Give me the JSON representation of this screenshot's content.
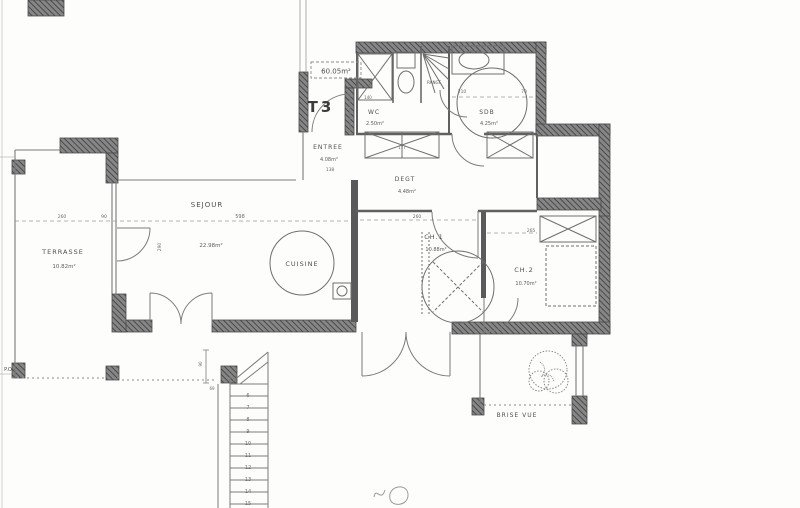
{
  "plan": {
    "unit_label": "T3",
    "total_area": "60.05m²"
  },
  "rooms": {
    "terrasse": {
      "name": "TERRASSE",
      "area": "10.82m²"
    },
    "sejour": {
      "name": "SEJOUR",
      "area": "22.98m²"
    },
    "cuisine": {
      "name": "CUISINE"
    },
    "entree": {
      "name": "ENTREE",
      "area": "4.08m²"
    },
    "wc": {
      "name": "WC",
      "area": "2.50m²"
    },
    "degagement": {
      "name": "DEGT",
      "area": "4.48m²"
    },
    "sdb": {
      "name": "SDB",
      "area": "4.25m²"
    },
    "ch1": {
      "name": "CH.1",
      "area": "10.88m²"
    },
    "ch2": {
      "name": "CH.2",
      "area": "10.70m²"
    },
    "rangement": {
      "name": "RANGT"
    }
  },
  "annotations": {
    "brise_vue": "BRISE VUE",
    "po": "P.O"
  },
  "dims": {
    "d1": "260",
    "d2": "90",
    "d3": "598",
    "d4": "290",
    "d5": "138",
    "d6": "177",
    "d7": "140",
    "d8": "210",
    "d9": "70",
    "d10": "260",
    "d11": "265",
    "d12": "69",
    "d13": "90"
  },
  "stairs": {
    "steps": [
      "6",
      "7",
      "8",
      "9",
      "10",
      "11",
      "12",
      "13",
      "14",
      "15"
    ]
  },
  "colors": {
    "paper": "#fdfdfb",
    "ink": "#4f4f4f",
    "wall": "#7d7d7d"
  }
}
